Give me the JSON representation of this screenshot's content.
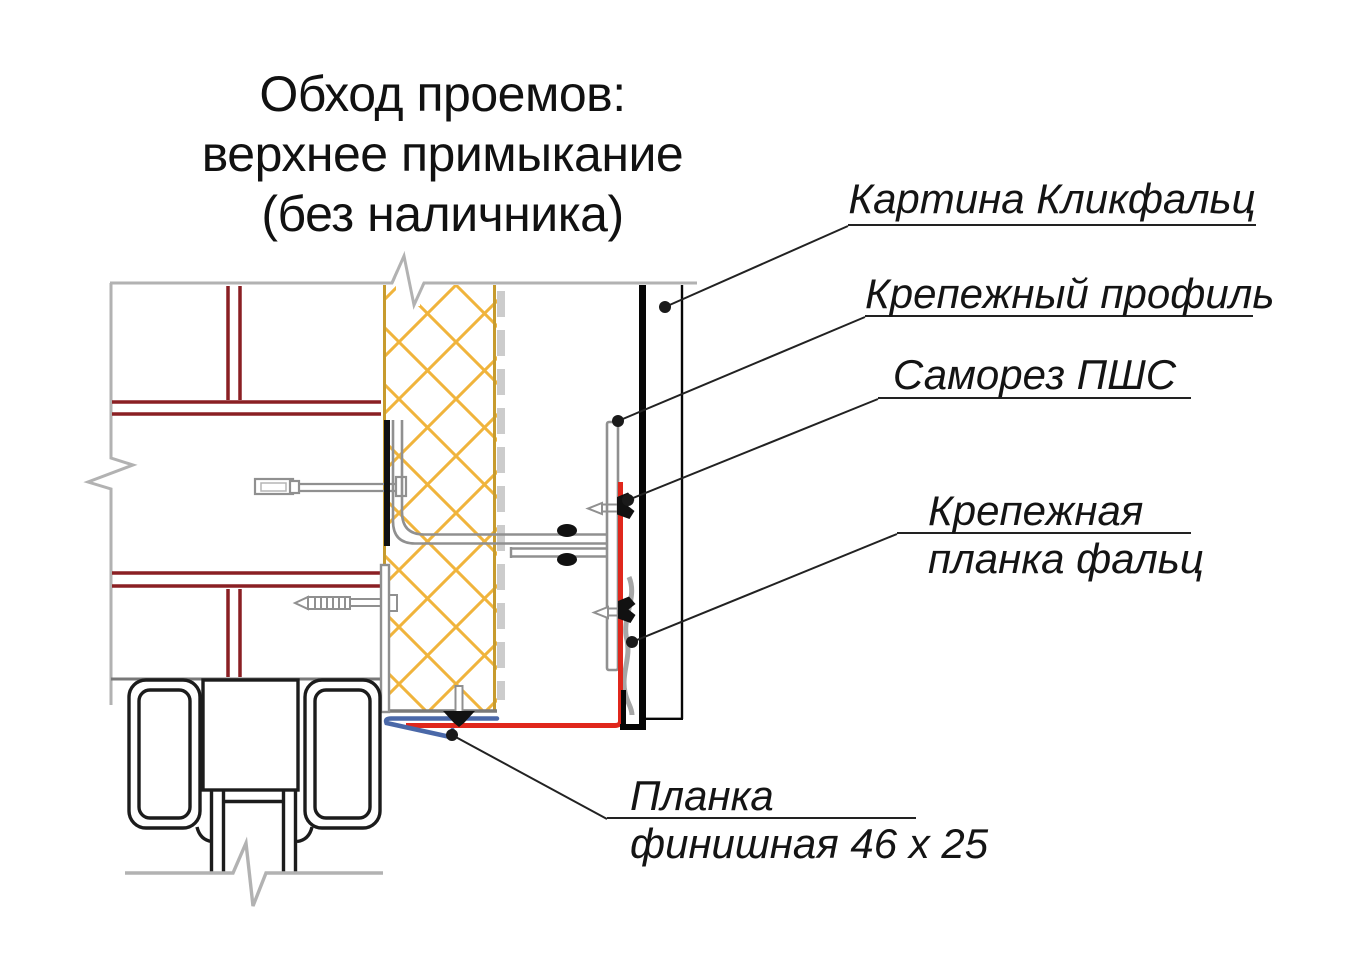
{
  "title": {
    "line1": "Обход проемов:",
    "line2": "верхнее примыкание",
    "line3": "(без наличника)"
  },
  "labels": {
    "klickfalz_panel": "Картина Кликфальц",
    "mounting_profile": "Крепежный профиль",
    "screw": "Саморез ПШС",
    "falz_strip_line1": "Крепежная",
    "falz_strip_line2": "планка фальц",
    "finish_strip_line1": "Планка",
    "finish_strip_line2": "финишная 46 x 25"
  },
  "colors": {
    "brick_joint": "#8a1f23",
    "insulation_hatch": "#f0b43c",
    "insulation_border": "#c79b2e",
    "membrane_gray": "#cccccc",
    "metal_gray": "#909090",
    "falz_strip_gray": "#a6a6a6",
    "flashing_red": "#e0271c",
    "flashing_blue": "#4a68a8",
    "panel_black": "#060606",
    "frame_black": "#1c1c1c",
    "wall_outline": "#b2b2b2",
    "leader": "#222222"
  }
}
